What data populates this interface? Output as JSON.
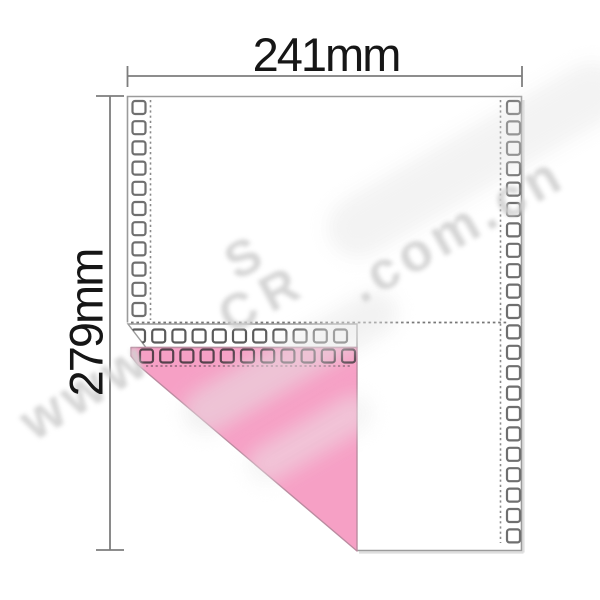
{
  "labels": {
    "width": "241mm",
    "height": "279mm"
  },
  "watermark": {
    "prefix": "www",
    "logo_top": "S",
    "logo_bottom": "CR",
    "suffix": ".com.cn"
  },
  "colors": {
    "sheet_border": "#9b9b9b",
    "hole_outline": "#6f6f6f",
    "strip_hole_outline": "#5a5a5a",
    "pink_hole_outline": "#56414c",
    "pink_fill": "#f6a0c5",
    "pink_edge": "#bb8ba0",
    "perforation": "#8a8a8a",
    "pink_perforation": "#8f6478",
    "page_perforation": "#777777",
    "dimension_line": "#7d7d7d",
    "label_color": "#161616",
    "watermark_color": "#d2d2d2",
    "shadow_color": "#dedede"
  },
  "holes": {
    "columns": [
      {
        "x": 132.5,
        "y_start": 101,
        "count": 11,
        "pitch": 20.2,
        "size": 13,
        "outline_key": "hole_outline"
      },
      {
        "x": 507,
        "y_start": 101,
        "count": 22,
        "pitch": 20.4,
        "size": 13,
        "outline_key": "hole_outline"
      }
    ],
    "rows": [
      {
        "y": 329.5,
        "x_start": 132,
        "count": 11,
        "pitch": 20.2,
        "size": 13,
        "outline_key": "strip_hole_outline",
        "clip": "stripClip"
      },
      {
        "y": 349.5,
        "x_start": 140,
        "count": 11,
        "pitch": 20.2,
        "size": 13,
        "outline_key": "pink_hole_outline",
        "clip": "pinkClip"
      }
    ]
  }
}
